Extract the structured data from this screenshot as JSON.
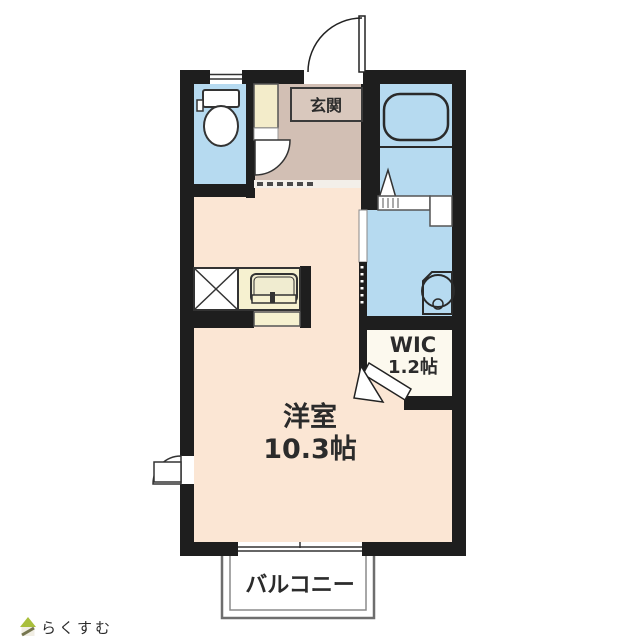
{
  "floorplan": {
    "rooms": {
      "entrance": {
        "label": "玄関"
      },
      "living": {
        "label": "洋室",
        "area": "10.3帖"
      },
      "wic": {
        "label": "WIC",
        "area": "1.2帖"
      },
      "balcony": {
        "label": "バルコニー"
      }
    },
    "colors": {
      "wall": "#1e1e1e",
      "water_rooms": "#b6daf0",
      "hallway": "#d2bfb4",
      "living_floor": "#fbe6d4",
      "kitchen_counter": "#f6f1d0",
      "hall_closet": "#f3ecca",
      "wic_floor": "#fcf9ee",
      "logo_green": "#a9bf3c",
      "logo_text": "#c8beb2"
    }
  },
  "branding": {
    "logo_text": "らくすむ"
  }
}
